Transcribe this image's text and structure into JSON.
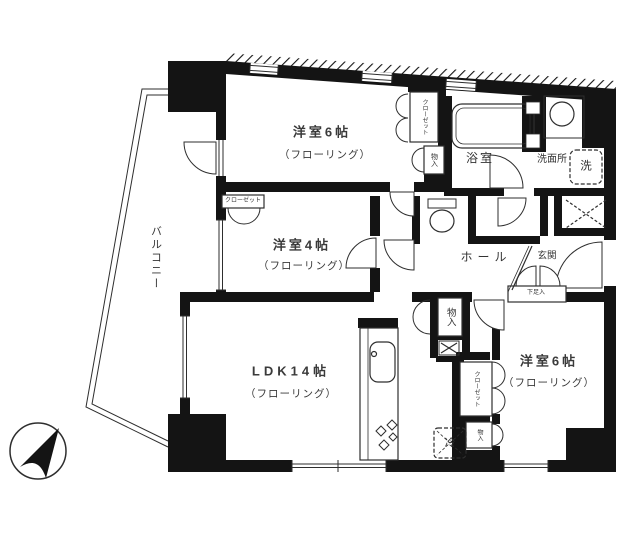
{
  "rooms": {
    "bedroom6_top": {
      "label": "洋室6帖",
      "sub": "（フローリング）"
    },
    "bedroom4": {
      "label": "洋室4帖",
      "sub": "（フローリング）"
    },
    "ldk": {
      "label": "LDK14帖",
      "sub": "（フローリング）"
    },
    "bedroom6_bottom": {
      "label": "洋室6帖",
      "sub": "（フローリング）"
    },
    "bath": {
      "label": "浴室"
    },
    "washroom": {
      "label": "洗面所"
    },
    "hall": {
      "label": "ホール"
    },
    "entrance": {
      "label": "玄関"
    },
    "balcony": {
      "label": "バルコニー"
    }
  },
  "storage": {
    "closet_top": "クローゼット",
    "closet_bedroom4": "クローゼット",
    "closet_bedroom6": "クローゼット",
    "storage_top": "物入",
    "storage_hall": "物入",
    "storage_bedroom6": "物入",
    "shoe_box": "下足入"
  },
  "appliances": {
    "washer": "洗",
    "fridge": "冷"
  },
  "icons": {
    "compass": "north-arrow-pointing-upper-right"
  },
  "colors": {
    "wall": "#141414",
    "line": "#2e2e2e",
    "background": "#ffffff"
  }
}
